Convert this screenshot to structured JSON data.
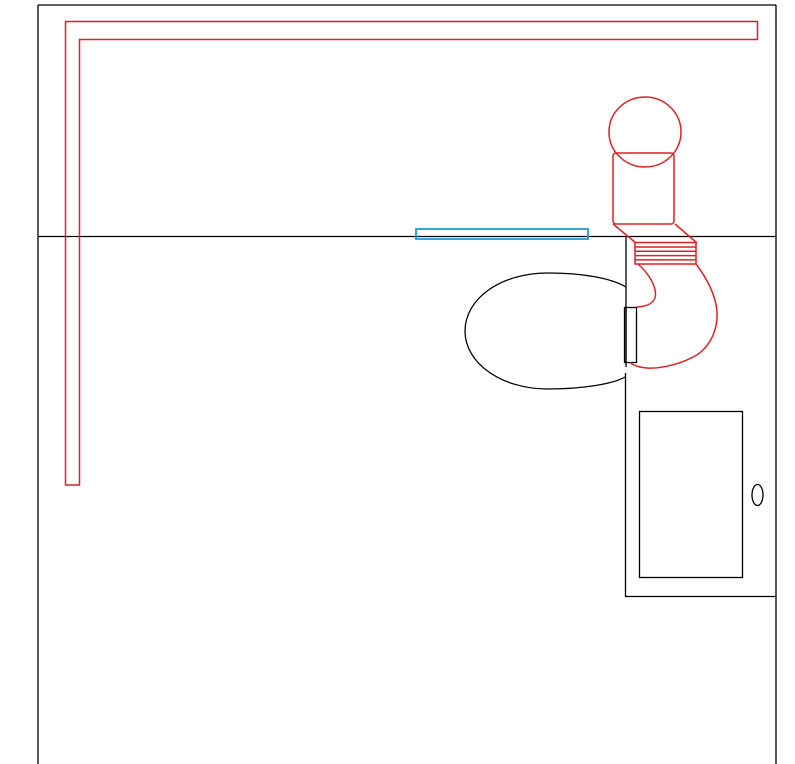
{
  "canvas": {
    "kind": "cad-line-drawing",
    "background": "#ffffff",
    "description": "Monochrome plan-view technical drawing with red piping overlay and a teal vent strip; no text labels visible"
  },
  "colors": {
    "line": "#000000",
    "red": "#dc2127",
    "teal": "#1c9fd6"
  },
  "shapes": [
    "perimeter-walls",
    "mid-partition-wall",
    "red-supply-pipe-run",
    "red-duct-circle",
    "red-duct-housing",
    "red-flex-hose",
    "red-trap-curve",
    "oval-fixture",
    "fixture-connector-box",
    "teal-vent-strip",
    "door-alcove",
    "door-panel",
    "door-knob"
  ]
}
